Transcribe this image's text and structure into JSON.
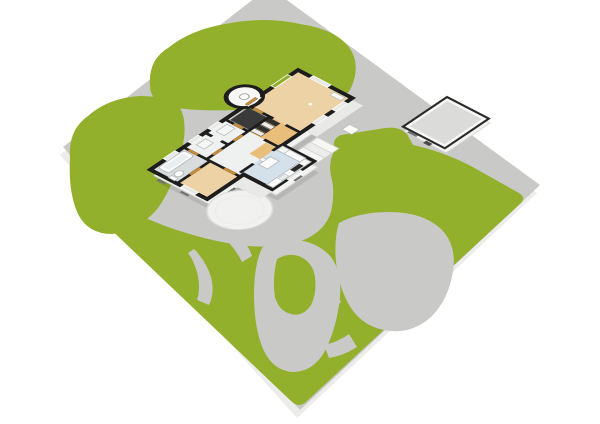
{
  "scene": {
    "type": "floorplan-3d-overview",
    "background": "#ffffff",
    "colors": {
      "grass": "#92b02c",
      "concrete": "#c9c9c7",
      "slab_side": "#ececea",
      "wall": "#1d1d1d",
      "white_wall": "#f8f8f6",
      "skirt": "#f3f3f1",
      "skirt_stroke": "#d7d7d5",
      "shadow": "rgba(0,0,0,0.09)",
      "wood": "#ecd2a4",
      "wood_orange": "#e9be7a",
      "kitchen_floor": "#d4e1ea",
      "bath_floor": "#d8dcdd",
      "hall_floor": "#eff1f0",
      "closet_dark": "#3a3a3a",
      "fixture": "#fbfbfb",
      "fixture_stroke": "#b6babc",
      "door": "#c9913f",
      "door_stroke": "#8a5a20",
      "window_glass": "#e8e8e6",
      "window_green": "#8fae2b",
      "garage_floor": "#dbdcda",
      "garage_rim": "#2a2a2a",
      "deck": "#e9e9e7",
      "step_light": "#f6f6f4",
      "step_dark": "#ececea",
      "step_stroke": "#cfcfcd",
      "porch": "#f1f1ef",
      "porch_stroke": "#dadad8",
      "slit": "#6f7274",
      "dark_slit": "#4a4a4a",
      "appliance_dark": "#2b2b2b",
      "tub_inner": "#e9eef1"
    },
    "lot": {
      "name": "property-lot",
      "ground": "concrete",
      "lawn": "grass"
    },
    "house": {
      "name": "main-house",
      "rooms": [
        {
          "id": "living-room",
          "floor": "wood"
        },
        {
          "id": "dining-hall",
          "floor": "wood_orange"
        },
        {
          "id": "closet",
          "floor": "closet_dark"
        },
        {
          "id": "hallway",
          "floor": "hall_floor"
        },
        {
          "id": "utility-room",
          "floor": "hall_floor"
        },
        {
          "id": "storage-room",
          "floor": "hall_floor"
        },
        {
          "id": "bathroom",
          "floor": "bath_floor"
        },
        {
          "id": "bedroom",
          "floor": "wood"
        },
        {
          "id": "kitchen",
          "floor": "kitchen_floor"
        }
      ],
      "features": [
        "round-turret",
        "curved-porch",
        "exterior-steps",
        "side-deck"
      ],
      "fixtures": [
        "bathtub",
        "toilet",
        "kitchen-counter",
        "cooktop",
        "kitchen-sink",
        "fridge",
        "kitchen-table",
        "wardrobes",
        "cabinets"
      ]
    },
    "garage": {
      "name": "detached-garage",
      "features": [
        "window-slit",
        "side-door"
      ]
    },
    "terrain": {
      "grass_areas": [
        "top-lawn",
        "left-lawn",
        "main-lawn",
        "lawn-island"
      ],
      "paths": [
        "street-band",
        "driveway",
        "patio-blob",
        "loop-path",
        "porch-path",
        "left-path",
        "edge-path"
      ]
    }
  }
}
